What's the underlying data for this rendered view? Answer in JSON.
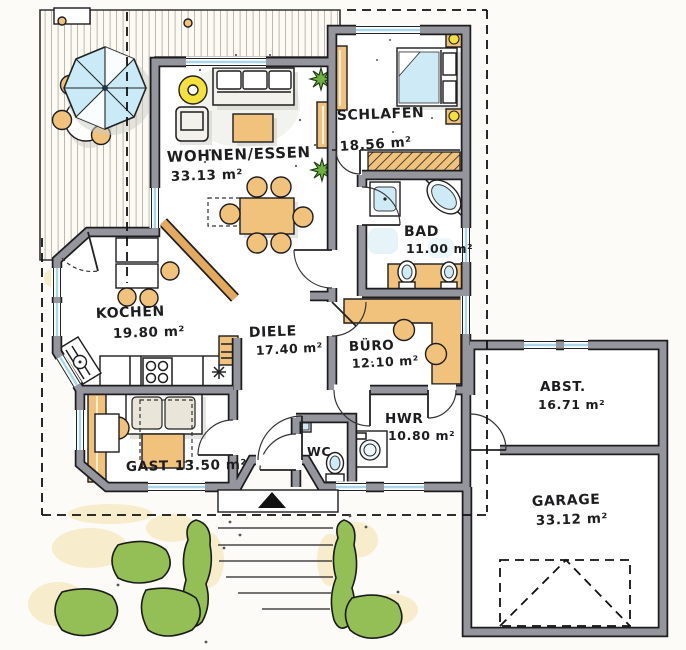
{
  "rooms": {
    "wohnen_essen": {
      "name": "WOHNEN/ESSEN",
      "area": "33.13 m²"
    },
    "schlafen": {
      "name": "SCHLAFEN",
      "area": "18.56 m²"
    },
    "bad": {
      "name": "BAD",
      "area": "11.00 m²"
    },
    "kochen": {
      "name": "KOCHEN",
      "area": "19.80 m²"
    },
    "diele": {
      "name": "DIELE",
      "area": "17.40 m²"
    },
    "buero": {
      "name": "BÜRO",
      "area": "12.10 m²"
    },
    "hwr": {
      "name": "HWR",
      "area": "10.80 m²"
    },
    "gast": {
      "name": "GAST",
      "area": "13.50 m²"
    },
    "wc": {
      "name": "WC",
      "area": ""
    },
    "abstellraum": {
      "name": "ABST.",
      "area": "16.71 m²"
    },
    "garage": {
      "name": "GARAGE",
      "area": "33.12 m²"
    }
  },
  "colors": {
    "paper": "#fcfbf7",
    "floor": "#ffffff",
    "wall_fill": "#95959d",
    "wall_outline": "#1d1d1f",
    "furniture_orange": "#f1c27c",
    "wood_orange": "#e3a95e",
    "glass_blue": "#a9d8ec",
    "water_blue": "#cdeaf6",
    "plant_green": "#6faf3f",
    "hedge_green": "#93bf56",
    "lamp_yellow": "#f4e13e",
    "shadow_gray": "#c9c9c3",
    "sand_beige": "#f6e9c4",
    "ink": "#1d1d1f"
  }
}
